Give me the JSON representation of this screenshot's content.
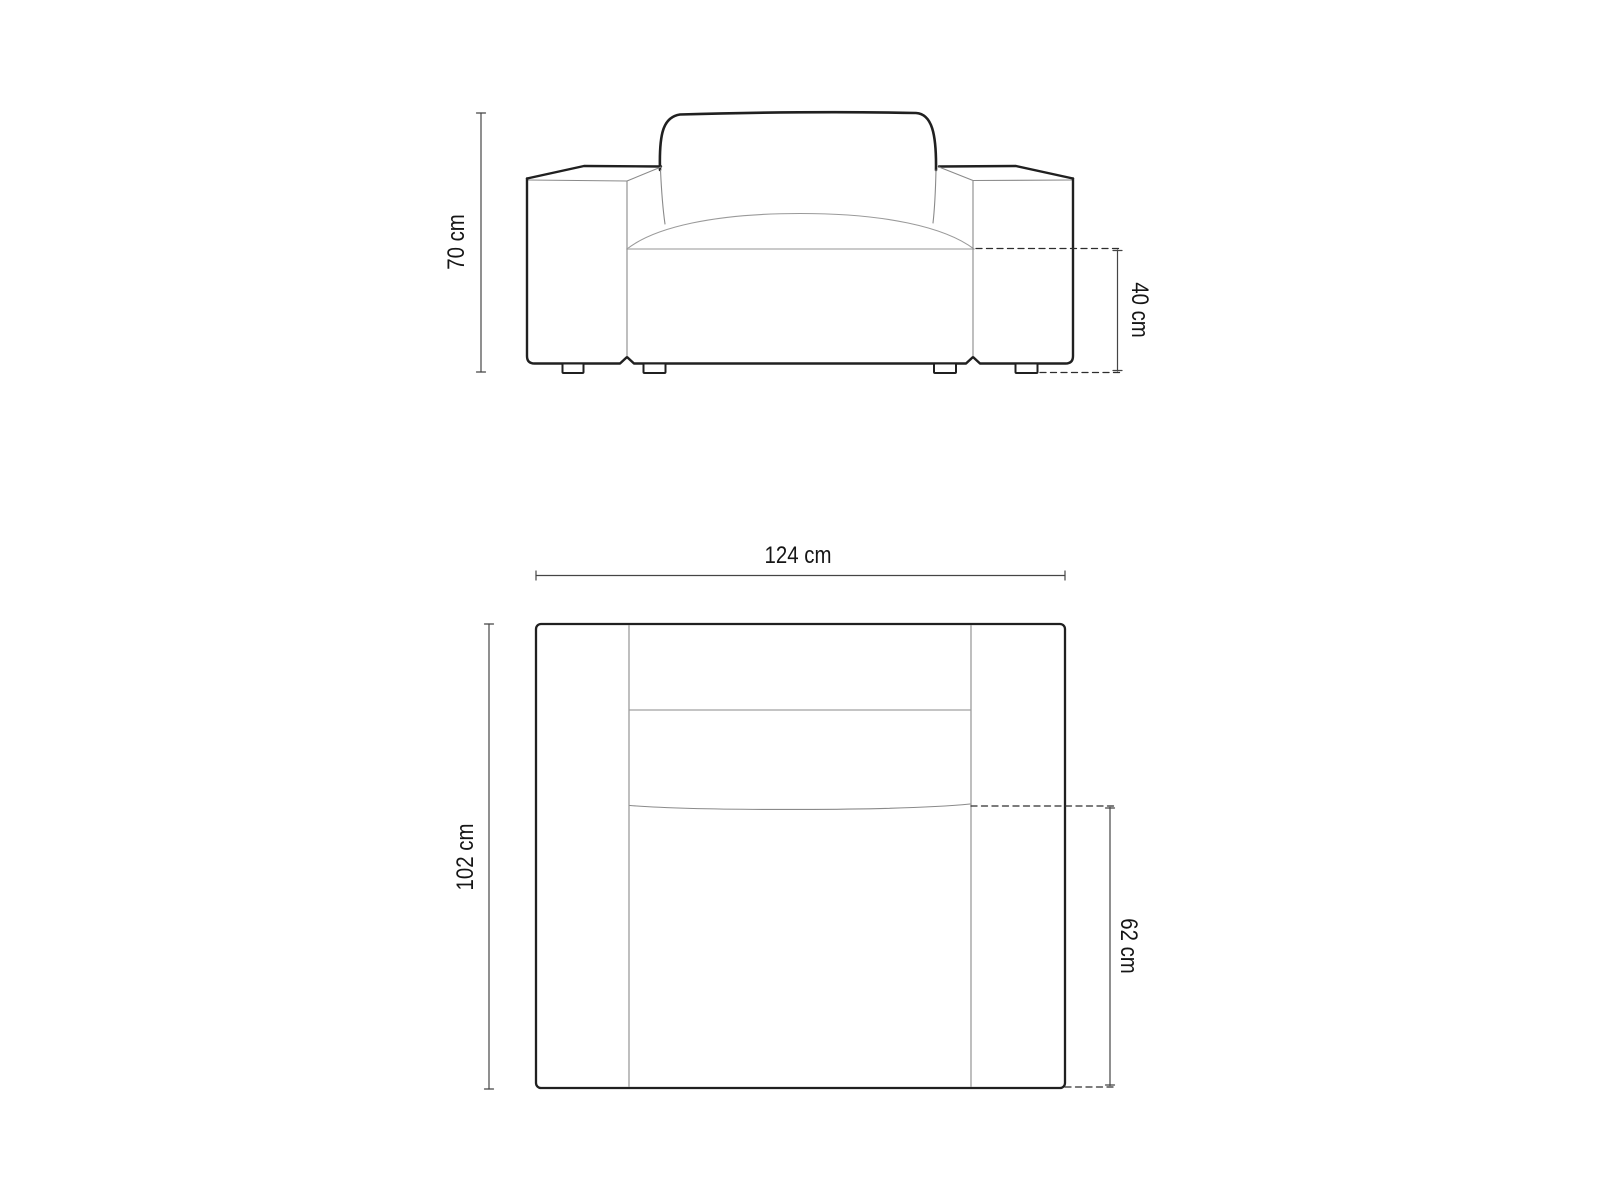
{
  "canvas": {
    "width": 1600,
    "height": 1200,
    "background": "#ffffff"
  },
  "diagram": {
    "subject": "armchair technical dimension drawing, front elevation and top plan",
    "front_view": {
      "dimensions": {
        "overall_height": {
          "label": "70 cm",
          "value": 70,
          "unit": "cm"
        },
        "seat_height": {
          "label": "40 cm",
          "value": 40,
          "unit": "cm"
        }
      }
    },
    "top_view": {
      "dimensions": {
        "overall_width": {
          "label": "124 cm",
          "value": 124,
          "unit": "cm"
        },
        "overall_depth": {
          "label": "102 cm",
          "value": 102,
          "unit": "cm"
        },
        "seat_depth": {
          "label": "62 cm",
          "value": 62,
          "unit": "cm"
        }
      }
    },
    "colors": {
      "outline": "#202020",
      "construction_line": "#8a8a8a",
      "seat_line": "#b9b9b9",
      "dimension_line": "#454545",
      "dashed_line": "#2e2e2e",
      "label_text": "#161616"
    }
  }
}
